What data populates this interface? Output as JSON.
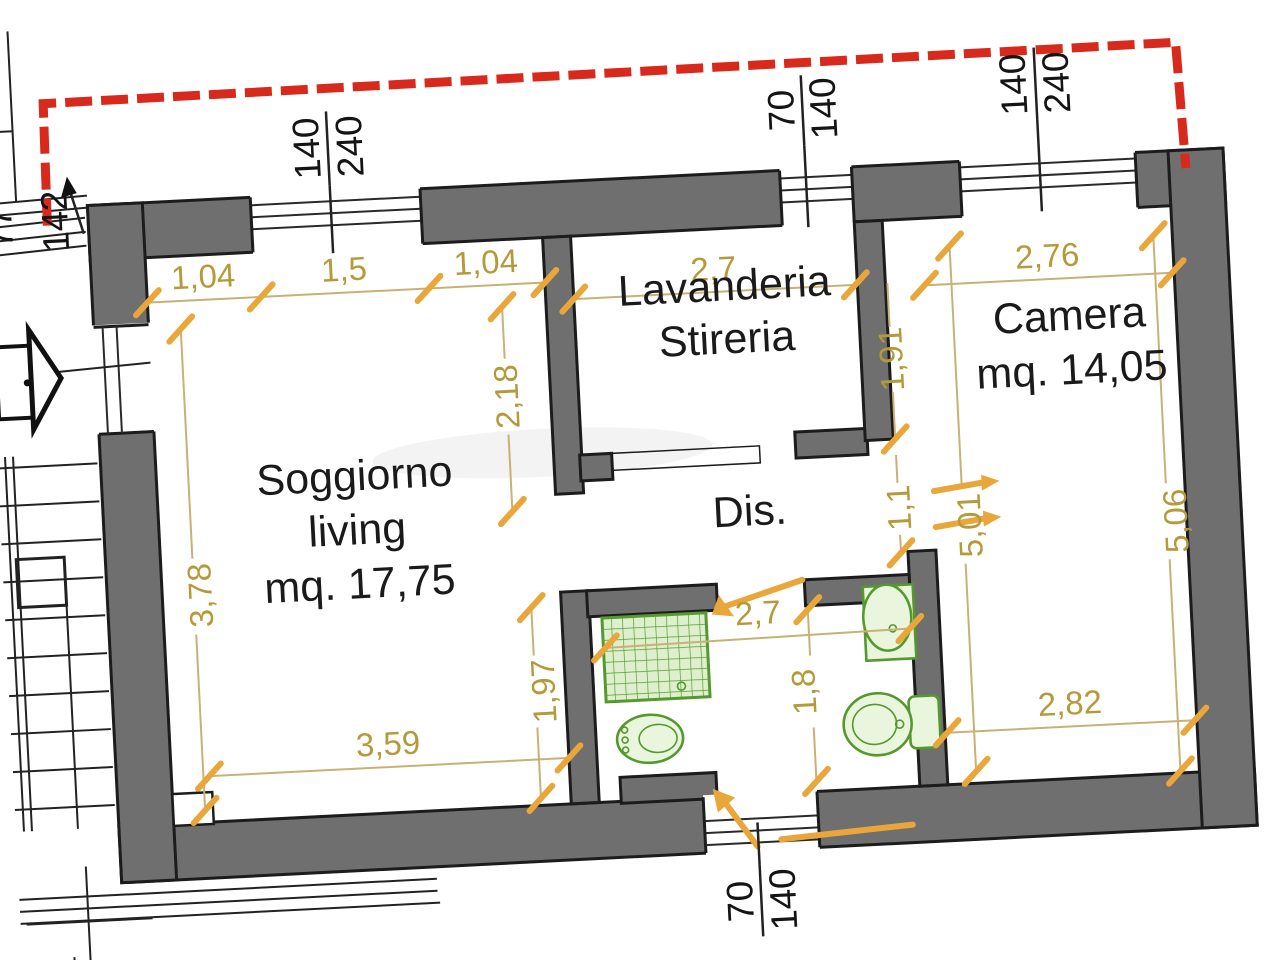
{
  "rooms": {
    "lavanderia": {
      "line1": "Lavanderia",
      "line2": "Stireria"
    },
    "soggiorno": {
      "line1": "Soggiorno",
      "line2": "living",
      "area": "mq. 17,75"
    },
    "camera": {
      "name": "Camera",
      "area": "mq. 14,05"
    },
    "dis": {
      "name": "Dis."
    }
  },
  "dims": {
    "sog_top_a": "1,04",
    "sog_top_b": "1,5",
    "sog_top_c": "1,04",
    "sog_right_top": "2,18",
    "sog_left": "3,78",
    "sog_bottom": "3,59",
    "sog_right_bottom": "1,97",
    "lav_width": "2,7",
    "lav_right": "1,91",
    "dis_passage": "1,1",
    "bath_width": "2,7",
    "bath_right": "1,8",
    "camera_top": "2,76",
    "camera_left": "5,01",
    "camera_right": "5,06",
    "camera_bottom": "2,82"
  },
  "openings": {
    "window_top_left": {
      "w": "140",
      "h": "240"
    },
    "window_top_mid": {
      "w": "70",
      "h": "140"
    },
    "window_top_right": {
      "w": "140",
      "h": "240"
    },
    "window_bottom": {
      "w": "70",
      "h": "140"
    },
    "left_dim_a": "77",
    "left_dim_b": "142"
  },
  "colors": {
    "wall_fill": "#6f6f6f",
    "wall_outline": "#1c1c1c",
    "boundary_red": "#d8291d",
    "dim_line": "#c9b176",
    "dim_text": "#b59a3c",
    "tick_orange": "#e9a63a",
    "fixture_green": "#55992e",
    "fixture_fill": "#eaf5de",
    "room_text": "#1a1a1a",
    "bg": "#ffffff"
  }
}
